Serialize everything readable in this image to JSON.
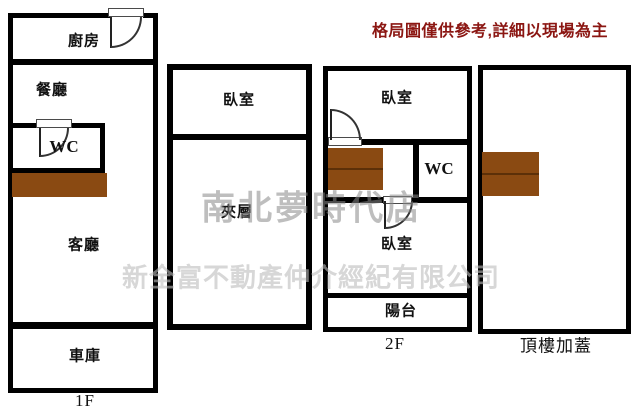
{
  "disclaimer": "格局圖僅供參考,詳細以現場為主",
  "watermark": {
    "store": "南北夢時代店",
    "company": "新全富不動產仲介經紀有限公司"
  },
  "colors": {
    "wall": "#000000",
    "stairs_fill": "#8a4a12",
    "stairs_divider": "#5c3008",
    "disclaimer_color": "#8b1612",
    "watermark_store_color": "#8a8a8a",
    "watermark_company_color": "#bdbdbd"
  },
  "plans": {
    "floor1": {
      "floor_label": "1F",
      "kitchen": "廚房",
      "dining": "餐廳",
      "wc": "WC",
      "living": "客廳",
      "garage": "車庫"
    },
    "mezzanine": {
      "bedroom": "臥室",
      "loft": "夾層"
    },
    "floor2": {
      "floor_label": "2F",
      "bedroom_front": "臥室",
      "wc": "WC",
      "bedroom_back": "臥室",
      "balcony": "陽台"
    },
    "rooftop": {
      "floor_label": "頂樓加蓋"
    }
  }
}
